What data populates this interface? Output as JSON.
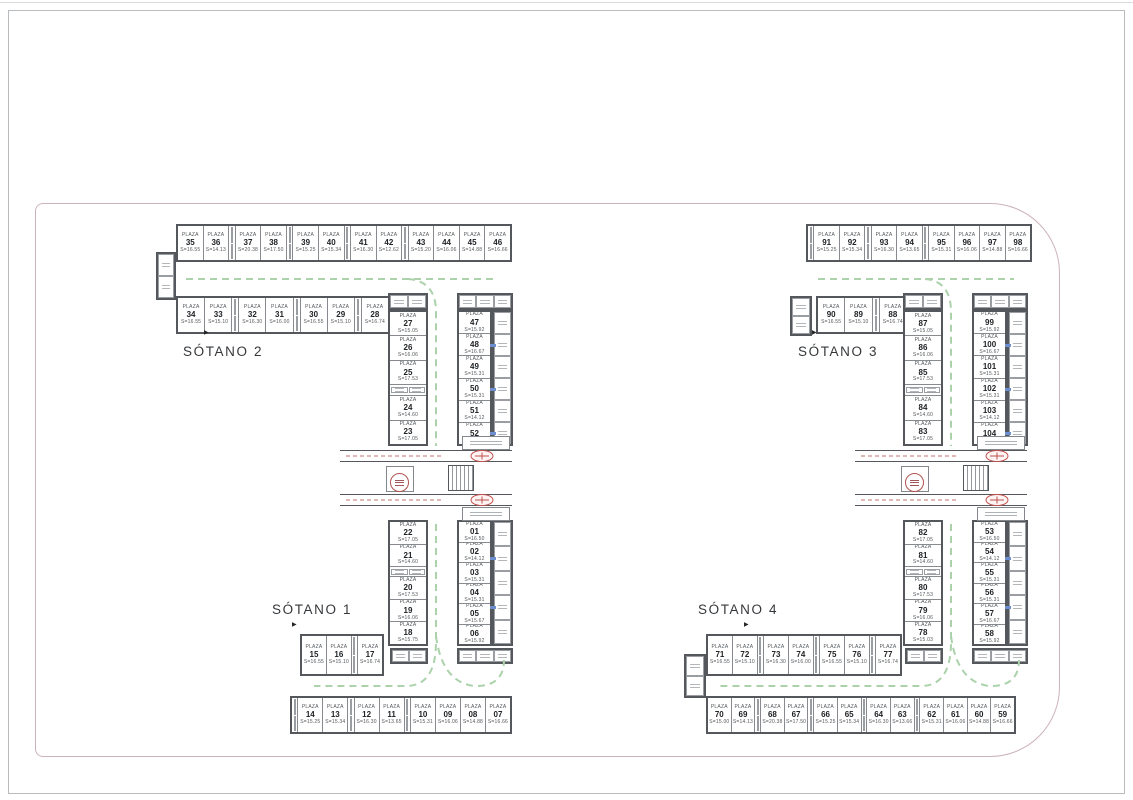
{
  "labels": {
    "plaza_word": "PLAZA",
    "area_prefix": "S=",
    "sotano_1": "SÓTANO 1",
    "sotano_2": "SÓTANO 2",
    "sotano_3": "SÓTANO 3",
    "sotano_4": "SÓTANO 4",
    "arrow_glyph": "▶"
  },
  "colors": {
    "wall": "#54585c",
    "stall_border": "#878b8f",
    "text": "#53575b",
    "number": "#202326",
    "lane_green": "#abd2ab",
    "detail_red": "#c0504d",
    "boundary_pink": "#ccb3b8",
    "door_blue": "#6d8ecf"
  },
  "plans": {
    "left": {
      "rows": {
        "top_outer": [
          {
            "n": "35",
            "s": "16.55"
          },
          {
            "n": "36",
            "s": "14.13"
          },
          {
            "t": 1
          },
          {
            "n": "37",
            "s": "20.38"
          },
          {
            "n": "38",
            "s": "17.50"
          },
          {
            "t": 1
          },
          {
            "n": "39",
            "s": "15.25"
          },
          {
            "n": "40",
            "s": "15.34"
          },
          {
            "t": 1
          },
          {
            "n": "41",
            "s": "16.30"
          },
          {
            "n": "42",
            "s": "12.62"
          },
          {
            "t": 1
          },
          {
            "n": "43",
            "s": "15.20"
          },
          {
            "n": "44",
            "s": "16.06"
          },
          {
            "n": "45",
            "s": "14.88"
          },
          {
            "n": "46",
            "s": "16.66"
          }
        ],
        "top_inner": [
          {
            "n": "34",
            "s": "16.55"
          },
          {
            "n": "33",
            "s": "15.10"
          },
          {
            "t": 1
          },
          {
            "n": "32",
            "s": "16.30"
          },
          {
            "n": "31",
            "s": "16.00"
          },
          {
            "t": 1
          },
          {
            "n": "30",
            "s": "16.55"
          },
          {
            "n": "29",
            "s": "15.10"
          },
          {
            "t": 1
          },
          {
            "n": "28",
            "s": "16.74"
          }
        ],
        "s2_inner": [
          {
            "n": "27",
            "s": "15.05"
          },
          {
            "n": "26",
            "s": "16.06"
          },
          {
            "n": "25",
            "s": "17.53"
          },
          {
            "t": 1
          },
          {
            "n": "24",
            "s": "14.60"
          },
          {
            "n": "23",
            "s": "17.05"
          }
        ],
        "s2_outer": [
          {
            "n": "47",
            "s": "15.92"
          },
          {
            "n": "48",
            "s": "16.67"
          },
          {
            "n": "49",
            "s": "15.31"
          },
          {
            "n": "50",
            "s": "15.31"
          },
          {
            "n": "51",
            "s": "14.12"
          },
          {
            "n": "52",
            "s": "16.50"
          }
        ],
        "s1_inner": [
          {
            "n": "22",
            "s": "17.05"
          },
          {
            "n": "21",
            "s": "14.60"
          },
          {
            "t": 1
          },
          {
            "n": "20",
            "s": "17.53"
          },
          {
            "n": "19",
            "s": "16.06"
          },
          {
            "n": "18",
            "s": "15.75"
          }
        ],
        "s1_outer": [
          {
            "n": "01",
            "s": "16.50"
          },
          {
            "n": "02",
            "s": "14.12"
          },
          {
            "n": "03",
            "s": "15.31"
          },
          {
            "n": "04",
            "s": "15.31"
          },
          {
            "n": "05",
            "s": "15.67"
          },
          {
            "n": "06",
            "s": "15.92"
          }
        ],
        "bot_inner": [
          {
            "n": "15",
            "s": "16.55"
          },
          {
            "n": "16",
            "s": "15.10"
          },
          {
            "t": 1
          },
          {
            "n": "17",
            "s": "16.74"
          }
        ],
        "bot_outer": [
          {
            "t": 1
          },
          {
            "n": "14",
            "s": "15.25"
          },
          {
            "n": "13",
            "s": "15.34"
          },
          {
            "t": 1
          },
          {
            "n": "12",
            "s": "16.30"
          },
          {
            "n": "11",
            "s": "13.65"
          },
          {
            "t": 1
          },
          {
            "n": "10",
            "s": "15.31"
          },
          {
            "n": "09",
            "s": "16.06"
          },
          {
            "n": "08",
            "s": "14.88"
          },
          {
            "n": "07",
            "s": "16.66"
          }
        ]
      }
    },
    "right": {
      "rows": {
        "top_outer": [
          {
            "t": 1
          },
          {
            "n": "91",
            "s": "15.25"
          },
          {
            "n": "92",
            "s": "15.34"
          },
          {
            "t": 1
          },
          {
            "n": "93",
            "s": "16.30"
          },
          {
            "n": "94",
            "s": "13.65"
          },
          {
            "t": 1
          },
          {
            "n": "95",
            "s": "15.31"
          },
          {
            "n": "96",
            "s": "16.06"
          },
          {
            "n": "97",
            "s": "14.88"
          },
          {
            "n": "98",
            "s": "16.66"
          }
        ],
        "top_inner": [
          {
            "n": "90",
            "s": "16.55"
          },
          {
            "n": "89",
            "s": "15.10"
          },
          {
            "t": 1
          },
          {
            "n": "88",
            "s": "16.74"
          }
        ],
        "s3_inner": [
          {
            "n": "87",
            "s": "15.05"
          },
          {
            "n": "86",
            "s": "16.06"
          },
          {
            "n": "85",
            "s": "17.53"
          },
          {
            "t": 1
          },
          {
            "n": "84",
            "s": "14.60"
          },
          {
            "n": "83",
            "s": "17.05"
          }
        ],
        "s3_outer": [
          {
            "n": "99",
            "s": "15.92"
          },
          {
            "n": "100",
            "s": "16.67"
          },
          {
            "n": "101",
            "s": "15.31"
          },
          {
            "n": "102",
            "s": "15.31"
          },
          {
            "n": "103",
            "s": "14.12"
          },
          {
            "n": "104",
            "s": "16.50"
          }
        ],
        "s4_inner": [
          {
            "n": "82",
            "s": "17.05"
          },
          {
            "n": "81",
            "s": "14.60"
          },
          {
            "t": 1
          },
          {
            "n": "80",
            "s": "17.53"
          },
          {
            "n": "79",
            "s": "16.06"
          },
          {
            "n": "78",
            "s": "15.03"
          }
        ],
        "s4_outer": [
          {
            "n": "53",
            "s": "16.50"
          },
          {
            "n": "54",
            "s": "14.12"
          },
          {
            "n": "55",
            "s": "15.31"
          },
          {
            "n": "56",
            "s": "15.31"
          },
          {
            "n": "57",
            "s": "16.67"
          },
          {
            "n": "58",
            "s": "15.92"
          }
        ],
        "bot_inner": [
          {
            "n": "71",
            "s": "16.55"
          },
          {
            "n": "72",
            "s": "15.10"
          },
          {
            "t": 1
          },
          {
            "n": "73",
            "s": "16.30"
          },
          {
            "n": "74",
            "s": "16.00"
          },
          {
            "t": 1
          },
          {
            "n": "75",
            "s": "16.55"
          },
          {
            "n": "76",
            "s": "15.10"
          },
          {
            "t": 1
          },
          {
            "n": "77",
            "s": "16.74"
          }
        ],
        "bot_outer": [
          {
            "n": "70",
            "s": "15.00"
          },
          {
            "n": "69",
            "s": "14.13"
          },
          {
            "t": 1
          },
          {
            "n": "68",
            "s": "20.38"
          },
          {
            "n": "67",
            "s": "17.50"
          },
          {
            "t": 1
          },
          {
            "n": "66",
            "s": "15.25"
          },
          {
            "n": "65",
            "s": "15.34"
          },
          {
            "t": 1
          },
          {
            "n": "64",
            "s": "16.30"
          },
          {
            "n": "63",
            "s": "13.66"
          },
          {
            "t": 1
          },
          {
            "n": "62",
            "s": "15.31"
          },
          {
            "n": "61",
            "s": "16.06"
          },
          {
            "n": "60",
            "s": "14.88"
          },
          {
            "n": "59",
            "s": "16.66"
          }
        ]
      }
    }
  }
}
